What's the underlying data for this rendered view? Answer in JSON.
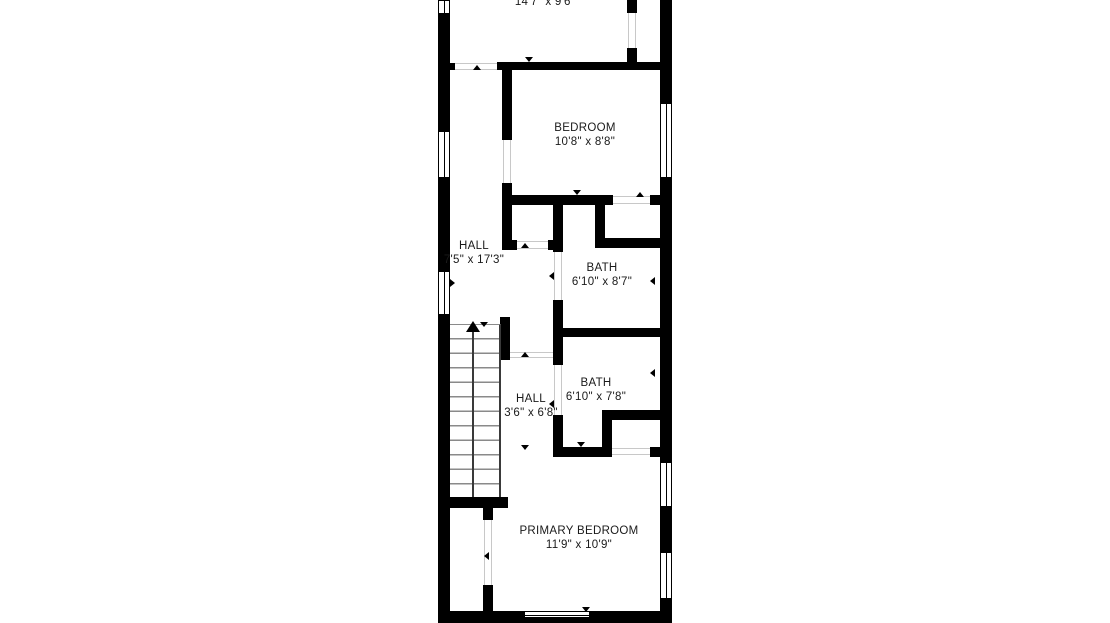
{
  "floorplan": {
    "type": "residential-floor-plan",
    "rooms": [
      {
        "id": "room-top-partial",
        "name": "",
        "dims": "14'7\" x 9'6\""
      },
      {
        "id": "bedroom",
        "name": "BEDROOM",
        "dims": "10'8\" x 8'8\""
      },
      {
        "id": "hall-upper",
        "name": "HALL",
        "dims": "7'5\" x 17'3\""
      },
      {
        "id": "bath-upper",
        "name": "BATH",
        "dims": "6'10\" x 8'7\""
      },
      {
        "id": "hall-lower",
        "name": "HALL",
        "dims": "3'6\" x 6'8\""
      },
      {
        "id": "bath-lower",
        "name": "BATH",
        "dims": "6'10\" x 7'8\""
      },
      {
        "id": "primary-bedroom",
        "name": "PRIMARY BEDROOM",
        "dims": "11'9\" x 10'9\""
      }
    ],
    "features": {
      "stairs": "straight-run with up arrow",
      "window_count": 7
    },
    "colors": {
      "background": "#ffffff",
      "wall": "#000000",
      "stair_tread": "#8a8a8a",
      "door_threshold": "#c8c8c8",
      "text": "#1a1a1a"
    }
  }
}
